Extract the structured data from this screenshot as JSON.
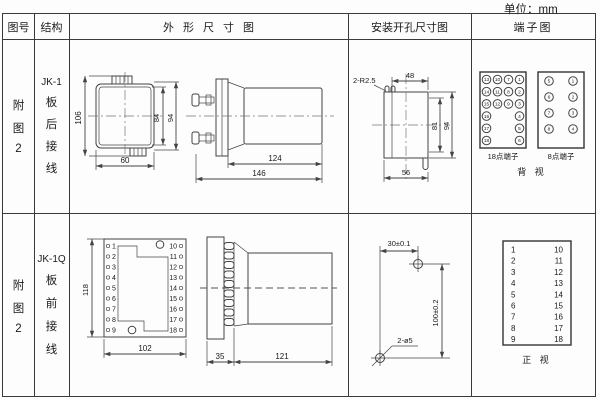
{
  "unit_label": "单位：mm",
  "header": {
    "figure": "图号",
    "structure": "结构",
    "outline": "外形尺寸图",
    "mounting": "安装开孔尺寸图",
    "terminal": "端子图"
  },
  "row1": {
    "figure_chars": [
      "附",
      "图",
      "2"
    ],
    "structure_lines": [
      "JK-1",
      "板",
      "后",
      "接",
      "线"
    ],
    "outline_dims": {
      "overall_height": "106",
      "case_height": "84",
      "cover_height": "94",
      "width": "60",
      "cover_length": "124",
      "overall_length": "146"
    },
    "mounting_dims": {
      "corner_radius": "2-R2.5",
      "top_width": "48",
      "inner_height": "81",
      "overall_height": "94",
      "bottom_width": "56"
    },
    "terminal_panel": {
      "box18_label": "18点端子",
      "box8_label": "8点端子",
      "view_label": "背 视",
      "box18_grid": [
        [
          "13",
          "10",
          "7",
          "1"
        ],
        [
          "14",
          "11",
          "8",
          "2"
        ],
        [
          "15",
          "12",
          "9",
          "3"
        ],
        [
          "16",
          "",
          "",
          "4"
        ],
        [
          "17",
          "",
          "",
          "5"
        ],
        [
          "18",
          "",
          "",
          "6"
        ]
      ],
      "box8_grid": [
        [
          "5",
          "1"
        ],
        [
          "6",
          "2"
        ],
        [
          "7",
          "3"
        ],
        [
          "8",
          "4"
        ]
      ]
    }
  },
  "row2": {
    "figure_chars": [
      "附",
      "图",
      "2"
    ],
    "structure_lines": [
      "JK-1Q",
      "板",
      "前",
      "接",
      "线"
    ],
    "outline_dims": {
      "height": "118",
      "width": "102",
      "plate_depth": "35",
      "body_length": "121"
    },
    "front_terminals": {
      "left": [
        "1",
        "2",
        "3",
        "4",
        "5",
        "6",
        "7",
        "8",
        "9"
      ],
      "right": [
        "10",
        "11",
        "12",
        "13",
        "14",
        "15",
        "16",
        "17",
        "18"
      ]
    },
    "mounting_dims": {
      "hole_spacing_h": "30±0.1",
      "hole_spacing_v": "100±0.2",
      "hole_label": "2-ø5"
    },
    "terminal_panel": {
      "left": [
        "1",
        "2",
        "3",
        "4",
        "5",
        "6",
        "7",
        "8",
        "9"
      ],
      "right": [
        "10",
        "11",
        "12",
        "13",
        "14",
        "15",
        "16",
        "17",
        "18"
      ],
      "view_label": "正 视"
    }
  }
}
